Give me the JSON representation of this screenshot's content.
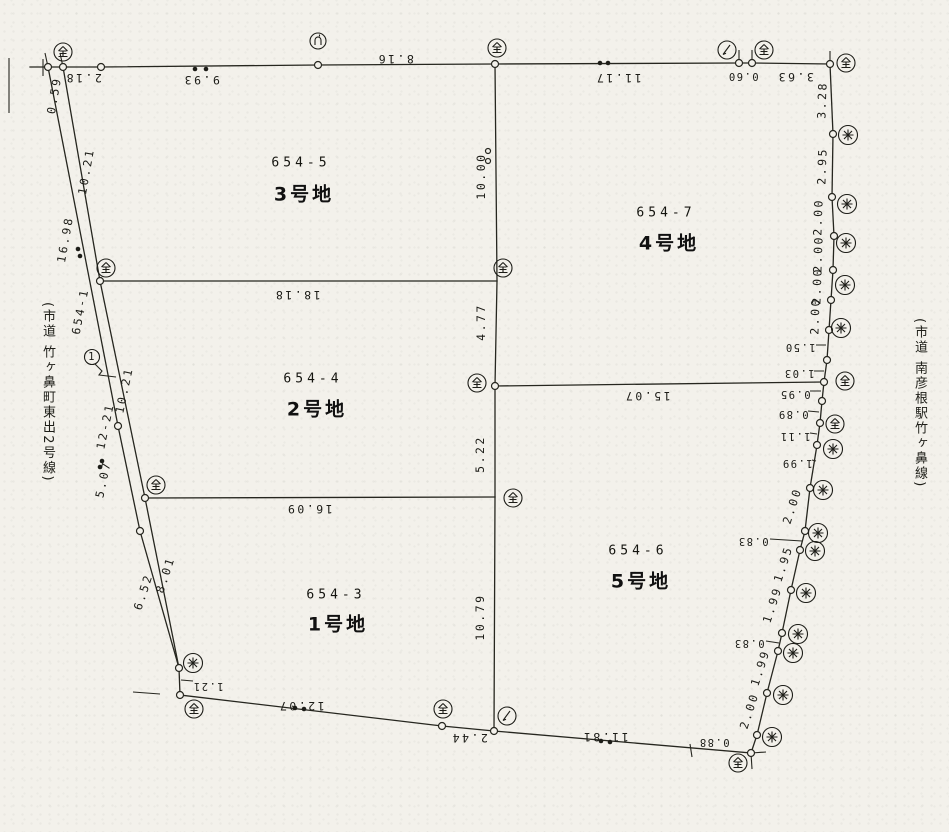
{
  "page": {
    "background": "#f3f1eb",
    "ink": "#26261f"
  },
  "roads": {
    "left": {
      "name": "(市道 竹ヶ鼻町東出2号線)",
      "lot_number": "654-1",
      "point_label": "1",
      "adjacent_lot_number": "12-21"
    },
    "right": {
      "name": "(市道 南彦根駅竹ヶ鼻線)"
    }
  },
  "parcels": [
    {
      "number": "654-5",
      "name": "3号地"
    },
    {
      "number": "654-7",
      "name": "4号地"
    },
    {
      "number": "654-4",
      "name": "2号地"
    },
    {
      "number": "654-3",
      "name": "1号地"
    },
    {
      "number": "654-6",
      "name": "5号地"
    }
  ],
  "dimensions": {
    "top": [
      "2.18",
      "9.93",
      "8.16",
      "11.17",
      "0.60",
      "3.63"
    ],
    "right": [
      "3.28",
      "2.95",
      "2.00",
      "2.00",
      "2.00",
      "2.00",
      "1.50",
      "1.03",
      "0.95",
      "0.89",
      "1.11",
      "1.99",
      "2.00",
      "0.83",
      "1.95",
      "1.99",
      "0.83",
      "1.99",
      "2.00",
      "0.88"
    ],
    "bottom": [
      "11.81",
      "2.44",
      "12.07",
      "1.21"
    ],
    "left": [
      "0.59",
      "10.21",
      "16.98",
      "10.21",
      "5.07",
      "6.52",
      "8.01"
    ],
    "center_line": [
      "10.00",
      "4.77",
      "5.22",
      "10.79"
    ],
    "cross_lines": [
      "18.18",
      "15.07",
      "16.09"
    ]
  }
}
